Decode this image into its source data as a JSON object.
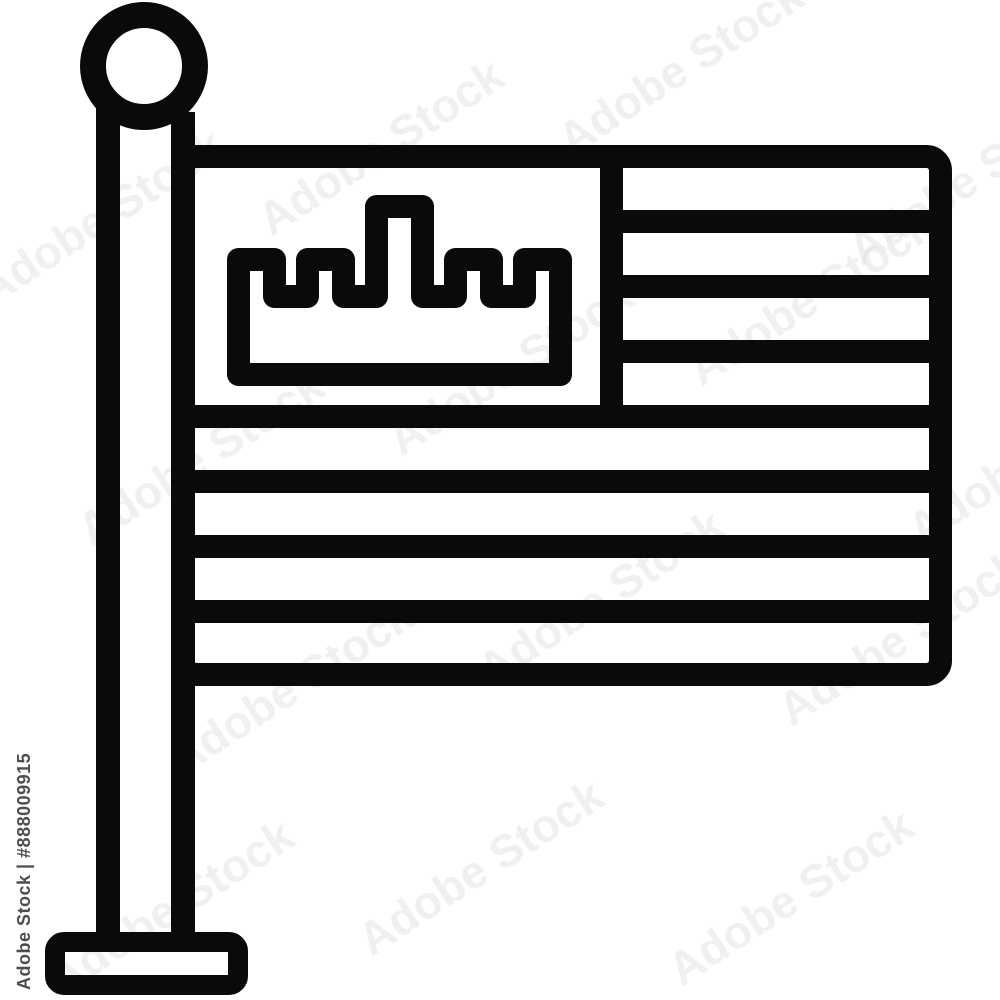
{
  "image": {
    "kind": "stock line icon",
    "subject": "flag on a pole with crown-castle canton and stripes",
    "background_color": "#ffffff",
    "icon_color": "#0a0a0a"
  },
  "watermark": {
    "brand": "Adobe Stock",
    "id_label": "Adobe Stock | #888009915",
    "tint": "rgba(90,90,90,0.09)",
    "tile_positions": [
      {
        "x": -40,
        "y": 190
      },
      {
        "x": 240,
        "y": 120
      },
      {
        "x": 540,
        "y": 40
      },
      {
        "x": 830,
        "y": 150
      },
      {
        "x": 60,
        "y": 430
      },
      {
        "x": 370,
        "y": 340
      },
      {
        "x": 670,
        "y": 270
      },
      {
        "x": 150,
        "y": 660
      },
      {
        "x": 460,
        "y": 570
      },
      {
        "x": 760,
        "y": 610
      },
      {
        "x": 30,
        "y": 880
      },
      {
        "x": 340,
        "y": 840
      },
      {
        "x": 650,
        "y": 870
      },
      {
        "x": 890,
        "y": 430
      }
    ]
  }
}
